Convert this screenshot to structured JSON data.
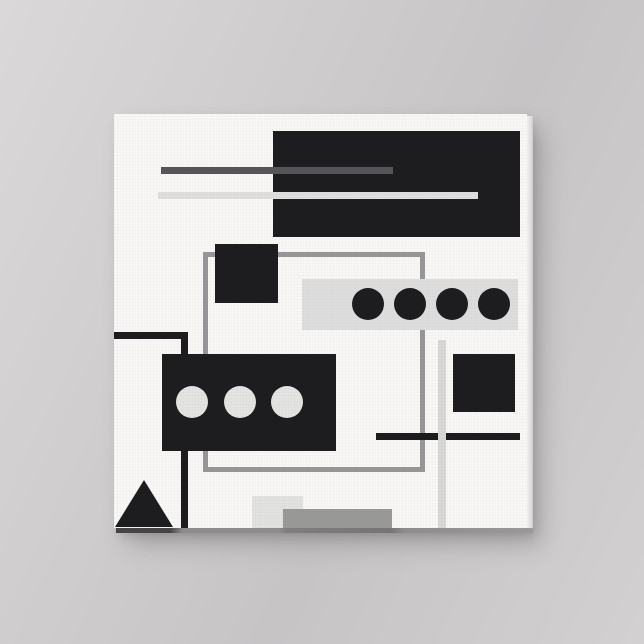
{
  "scene": {
    "description": "Square gallery-wrapped canvas print with black, white and gray abstract geometric artwork, hung on a light gray wall with soft drop shadow",
    "wall_color": "#cecccc",
    "canvas_color": "#f8f7f5",
    "shadow_color": "#9a9898",
    "edge_right_color": "#e2e0df",
    "edge_bottom_color": "#8d8d8d"
  },
  "artwork": {
    "style": "abstract geometric, black white gray",
    "width": 413,
    "height": 414,
    "palette": {
      "near_black": "#1d1d1f",
      "dark_gray": "#55555a",
      "medium_gray": "#97979a",
      "light_gray": "#dcdddc",
      "off_white": "#f8f7f5"
    },
    "shapes": [
      {
        "id": "gray-frame-outline",
        "type": "frame",
        "x": 89,
        "y": 138,
        "w": 222,
        "h": 220,
        "stroke": 5,
        "color": "#97979a",
        "z": 1
      },
      {
        "id": "black-l-line-horizontal",
        "type": "rect",
        "x": 0,
        "y": 218,
        "w": 74,
        "h": 7,
        "color": "#1d1d1f",
        "z": 1
      },
      {
        "id": "black-l-line-vertical",
        "type": "rect",
        "x": 67,
        "y": 218,
        "w": 7,
        "h": 196,
        "color": "#1d1d1f",
        "z": 1
      },
      {
        "id": "light-gray-rect-bottom",
        "type": "rect",
        "x": 138,
        "y": 382,
        "w": 51,
        "h": 32,
        "color": "#e2e2e1",
        "z": 1
      },
      {
        "id": "large-black-rect",
        "type": "rect",
        "x": 159,
        "y": 17,
        "w": 247,
        "h": 106,
        "color": "#1d1d1f",
        "z": 2
      },
      {
        "id": "dark-gray-stripe",
        "type": "rect",
        "x": 47,
        "y": 53,
        "w": 232,
        "h": 7,
        "color": "#55555a",
        "z": 3
      },
      {
        "id": "light-gray-stripe",
        "type": "rect",
        "x": 44,
        "y": 78,
        "w": 320,
        "h": 7,
        "color": "#dedede",
        "z": 3
      },
      {
        "id": "small-black-square-top",
        "type": "rect",
        "x": 101,
        "y": 130,
        "w": 63,
        "h": 59,
        "color": "#1d1d1f",
        "z": 2
      },
      {
        "id": "dotted-bar",
        "type": "rect",
        "x": 188,
        "y": 165,
        "w": 216,
        "h": 51,
        "color": "#dcdddc",
        "z": 2,
        "dots": [
          {
            "cx": 66,
            "cy": 25,
            "r": 16,
            "color": "#1d1d1f"
          },
          {
            "cx": 108,
            "cy": 25,
            "r": 16,
            "color": "#1d1d1f"
          },
          {
            "cx": 150,
            "cy": 25,
            "r": 16,
            "color": "#1d1d1f"
          },
          {
            "cx": 192,
            "cy": 25,
            "r": 16,
            "color": "#1d1d1f"
          }
        ]
      },
      {
        "id": "black-rect-three-circles",
        "type": "rect",
        "x": 48,
        "y": 240,
        "w": 174,
        "h": 97,
        "color": "#1d1d1f",
        "z": 2,
        "dots": [
          {
            "cx": 30,
            "cy": 48,
            "r": 16,
            "color": "#e4e4e3"
          },
          {
            "cx": 78,
            "cy": 48,
            "r": 16,
            "color": "#e4e4e3"
          },
          {
            "cx": 125,
            "cy": 48,
            "r": 16,
            "color": "#e4e4e3"
          }
        ]
      },
      {
        "id": "black-square-right",
        "type": "rect",
        "x": 339,
        "y": 240,
        "w": 62,
        "h": 58,
        "color": "#1d1d1f",
        "z": 2
      },
      {
        "id": "black-line-horizontal",
        "type": "rect",
        "x": 262,
        "y": 319,
        "w": 144,
        "h": 7,
        "color": "#1d1d1f",
        "z": 3
      },
      {
        "id": "light-gray-line-vertical",
        "type": "rect",
        "x": 324,
        "y": 226,
        "w": 8,
        "h": 188,
        "color": "#d7d7d6",
        "z": 4
      },
      {
        "id": "black-triangle",
        "type": "triangle",
        "x": 1,
        "y": 366,
        "w": 58,
        "h": 47,
        "color": "#1d1d1f",
        "z": 2
      },
      {
        "id": "medium-gray-bar-bottom",
        "type": "rect",
        "x": 169,
        "y": 395,
        "w": 109,
        "h": 19,
        "color": "#999998",
        "z": 2
      }
    ]
  }
}
